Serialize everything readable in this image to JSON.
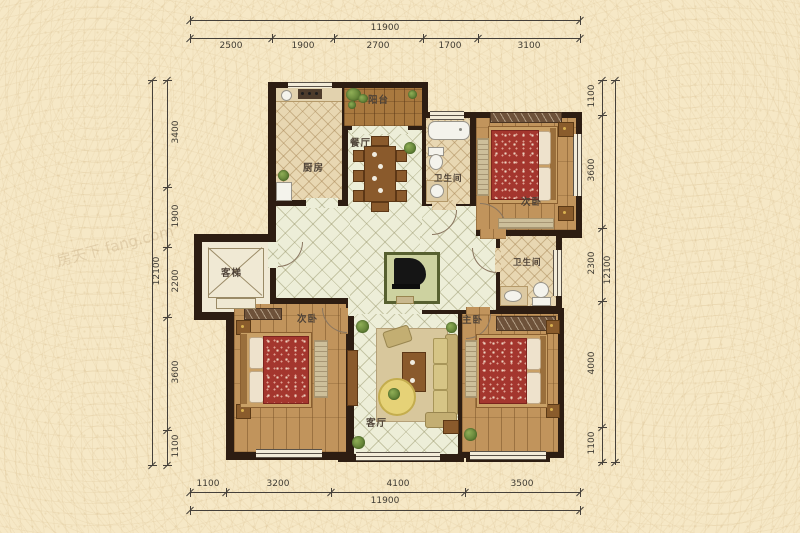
{
  "watermark": {
    "text": "房天下 fang.com"
  },
  "dims": {
    "top": {
      "total": "11900",
      "segments": [
        "2500",
        "1900",
        "2700",
        "1700",
        "3100"
      ]
    },
    "bottom": {
      "total": "11900",
      "segments": [
        "1100",
        "3200",
        "4100",
        "3500"
      ]
    },
    "left": {
      "total": "12100",
      "segments": [
        "3400",
        "1900",
        "2200",
        "3600",
        "1100"
      ]
    },
    "right": {
      "total": "12100",
      "segments": [
        "1100",
        "3600",
        "2300",
        "4000",
        "1100"
      ]
    }
  },
  "rooms": {
    "kitchen": {
      "label": "厨房"
    },
    "balcony": {
      "label": "阳台"
    },
    "dining": {
      "label": "餐厅"
    },
    "bath_top": {
      "label": "卫生间"
    },
    "bath_mid": {
      "label": "卫生间"
    },
    "bedroom_top_right": {
      "label": "次卧"
    },
    "bedroom_bottom_left": {
      "label": "次卧"
    },
    "master_bedroom": {
      "label": "主卧"
    },
    "living_room": {
      "label": "客厅"
    },
    "elevator": {
      "label": "客梯"
    }
  },
  "colors": {
    "wall": "#2d1d12",
    "pale_tile": "#edeed8",
    "beige_tile": "#e8d7b2",
    "wood": "#c1945c",
    "background": "#f6e8c6"
  }
}
